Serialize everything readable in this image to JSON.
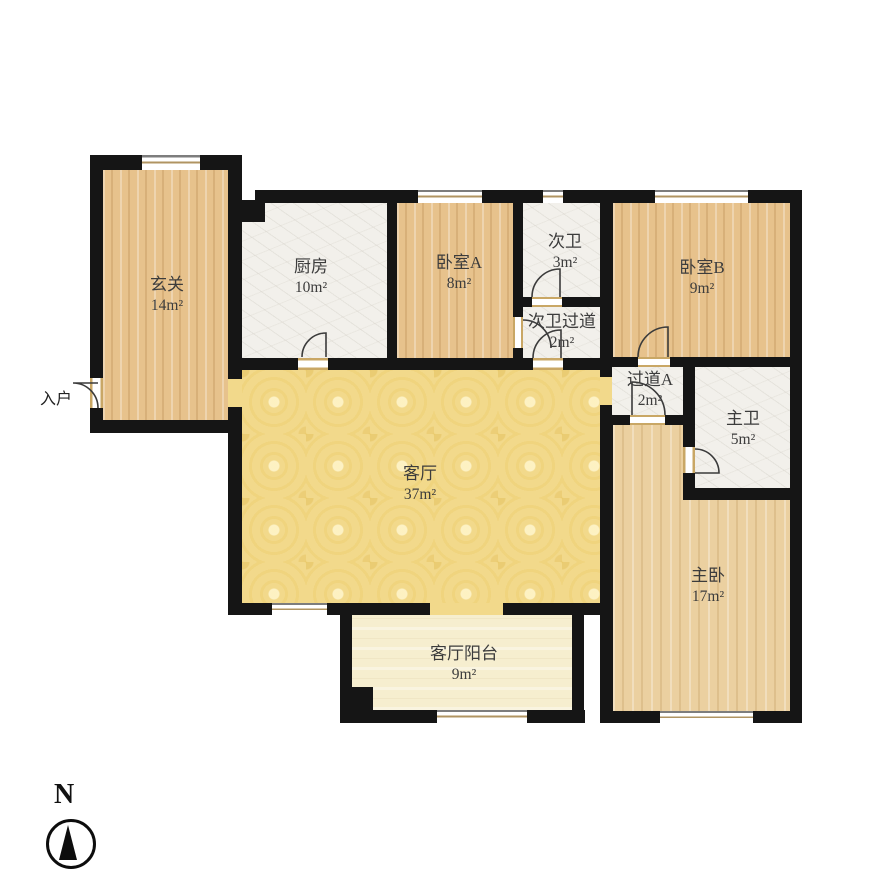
{
  "plan": {
    "rooms": [
      {
        "id": "entry",
        "name": "玄关",
        "area": "14m²"
      },
      {
        "id": "kitchen",
        "name": "厨房",
        "area": "10m²"
      },
      {
        "id": "bedroom-a",
        "name": "卧室A",
        "area": "8m²"
      },
      {
        "id": "bath-2",
        "name": "次卫",
        "area": "3m²"
      },
      {
        "id": "bedroom-b",
        "name": "卧室B",
        "area": "9m²"
      },
      {
        "id": "bath2-hall",
        "name": "次卫过道",
        "area": "2m²"
      },
      {
        "id": "hall-a",
        "name": "过道A",
        "area": "2m²"
      },
      {
        "id": "bath-1",
        "name": "主卫",
        "area": "5m²"
      },
      {
        "id": "living",
        "name": "客厅",
        "area": "37m²"
      },
      {
        "id": "master",
        "name": "主卧",
        "area": "17m²"
      },
      {
        "id": "balcony",
        "name": "客厅阳台",
        "area": "9m²"
      }
    ],
    "entrance": {
      "label": "入户"
    },
    "compass": {
      "label": "N"
    },
    "colors": {
      "wall": "#151515",
      "wood": "#e7c28c",
      "wood_light": "#ebd0a0",
      "marble": "#f2f0eb",
      "living_yellow": "#f2d98b",
      "balcony_cream": "#f6eecf"
    }
  }
}
